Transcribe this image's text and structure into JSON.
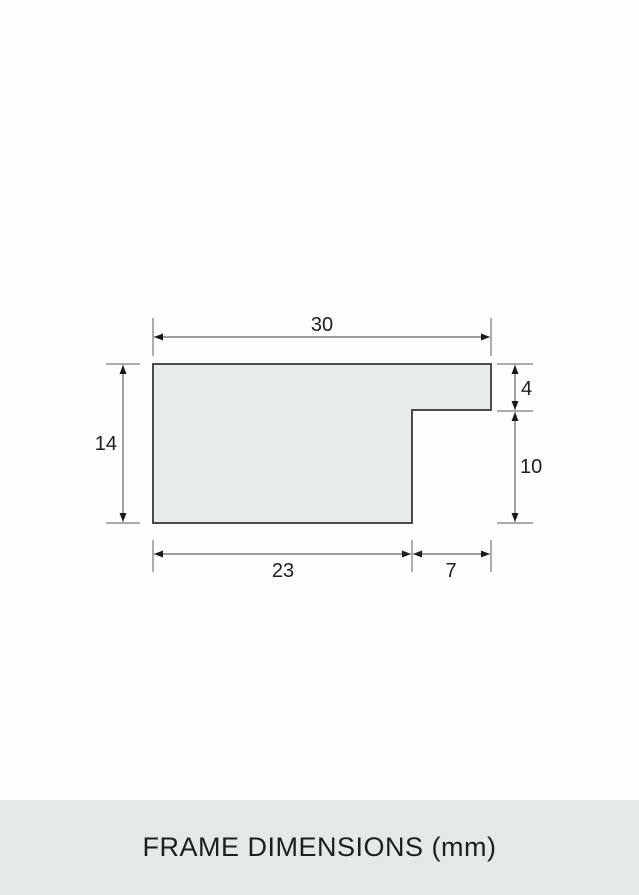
{
  "title": {
    "label": "FRAME DIMENSIONS (mm)"
  },
  "diagram": {
    "type": "frame-profile-cross-section",
    "unit": "mm",
    "dimensions": {
      "overall_width": "30",
      "overall_height": "14",
      "lip_thickness": "4",
      "rabbet_depth": "10",
      "base_width": "23",
      "rabbet_width": "7"
    },
    "colors": {
      "profile_fill": "#e8ece8",
      "profile_stroke": "#4a4a4a",
      "dimension_line": "#3f3f3f",
      "arrow": "#1a1a1a",
      "label_text": "#1e1e1e",
      "caption_bar_bg": "#e5e9e5",
      "page_bg": "#fdfdfd"
    }
  }
}
